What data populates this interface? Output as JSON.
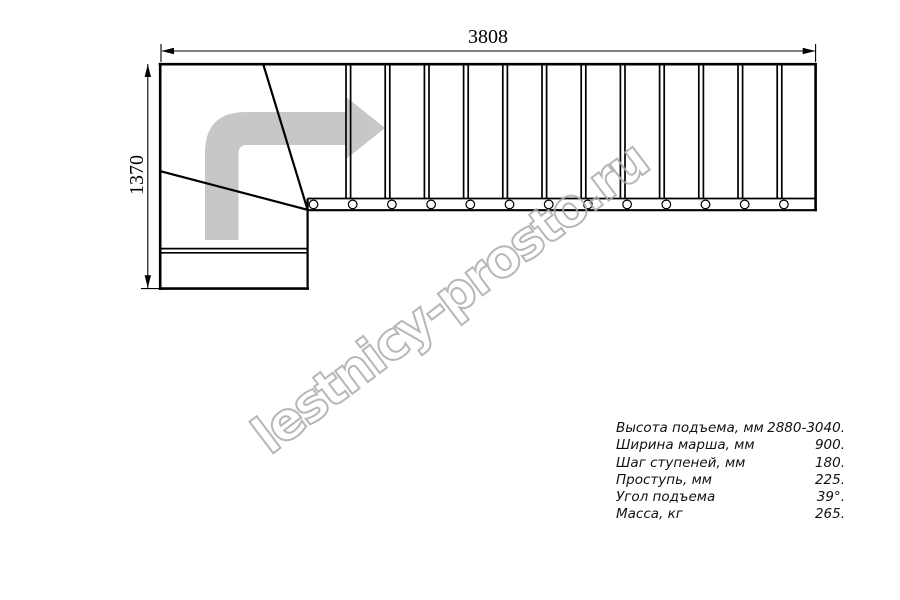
{
  "page": {
    "title": "Staircase plan drawing",
    "background": "#ffffff"
  },
  "dimensions": {
    "total_length_mm": "3808",
    "total_width_mm": "1370"
  },
  "watermark": {
    "text": "lestnicy-prosto.ru",
    "color": "#ababab"
  },
  "specs": {
    "rows": [
      {
        "label": "Высота подъема, мм",
        "value": "2880-3040."
      },
      {
        "label": "Ширина марша, мм",
        "value": "900."
      },
      {
        "label": "Шаг ступеней, мм",
        "value": "180."
      },
      {
        "label": "Проступь, мм",
        "value": "225."
      },
      {
        "label": "Угол подъема",
        "value": "39°."
      },
      {
        "label": "Масса, кг",
        "value": "265."
      }
    ]
  },
  "drawing": {
    "straight_tread_count": 13,
    "winder_tread_count": 3,
    "baluster_count": 13,
    "direction_arrow": "up-then-right",
    "arrow_color": "#c7c7c7",
    "line_color": "#000000"
  }
}
